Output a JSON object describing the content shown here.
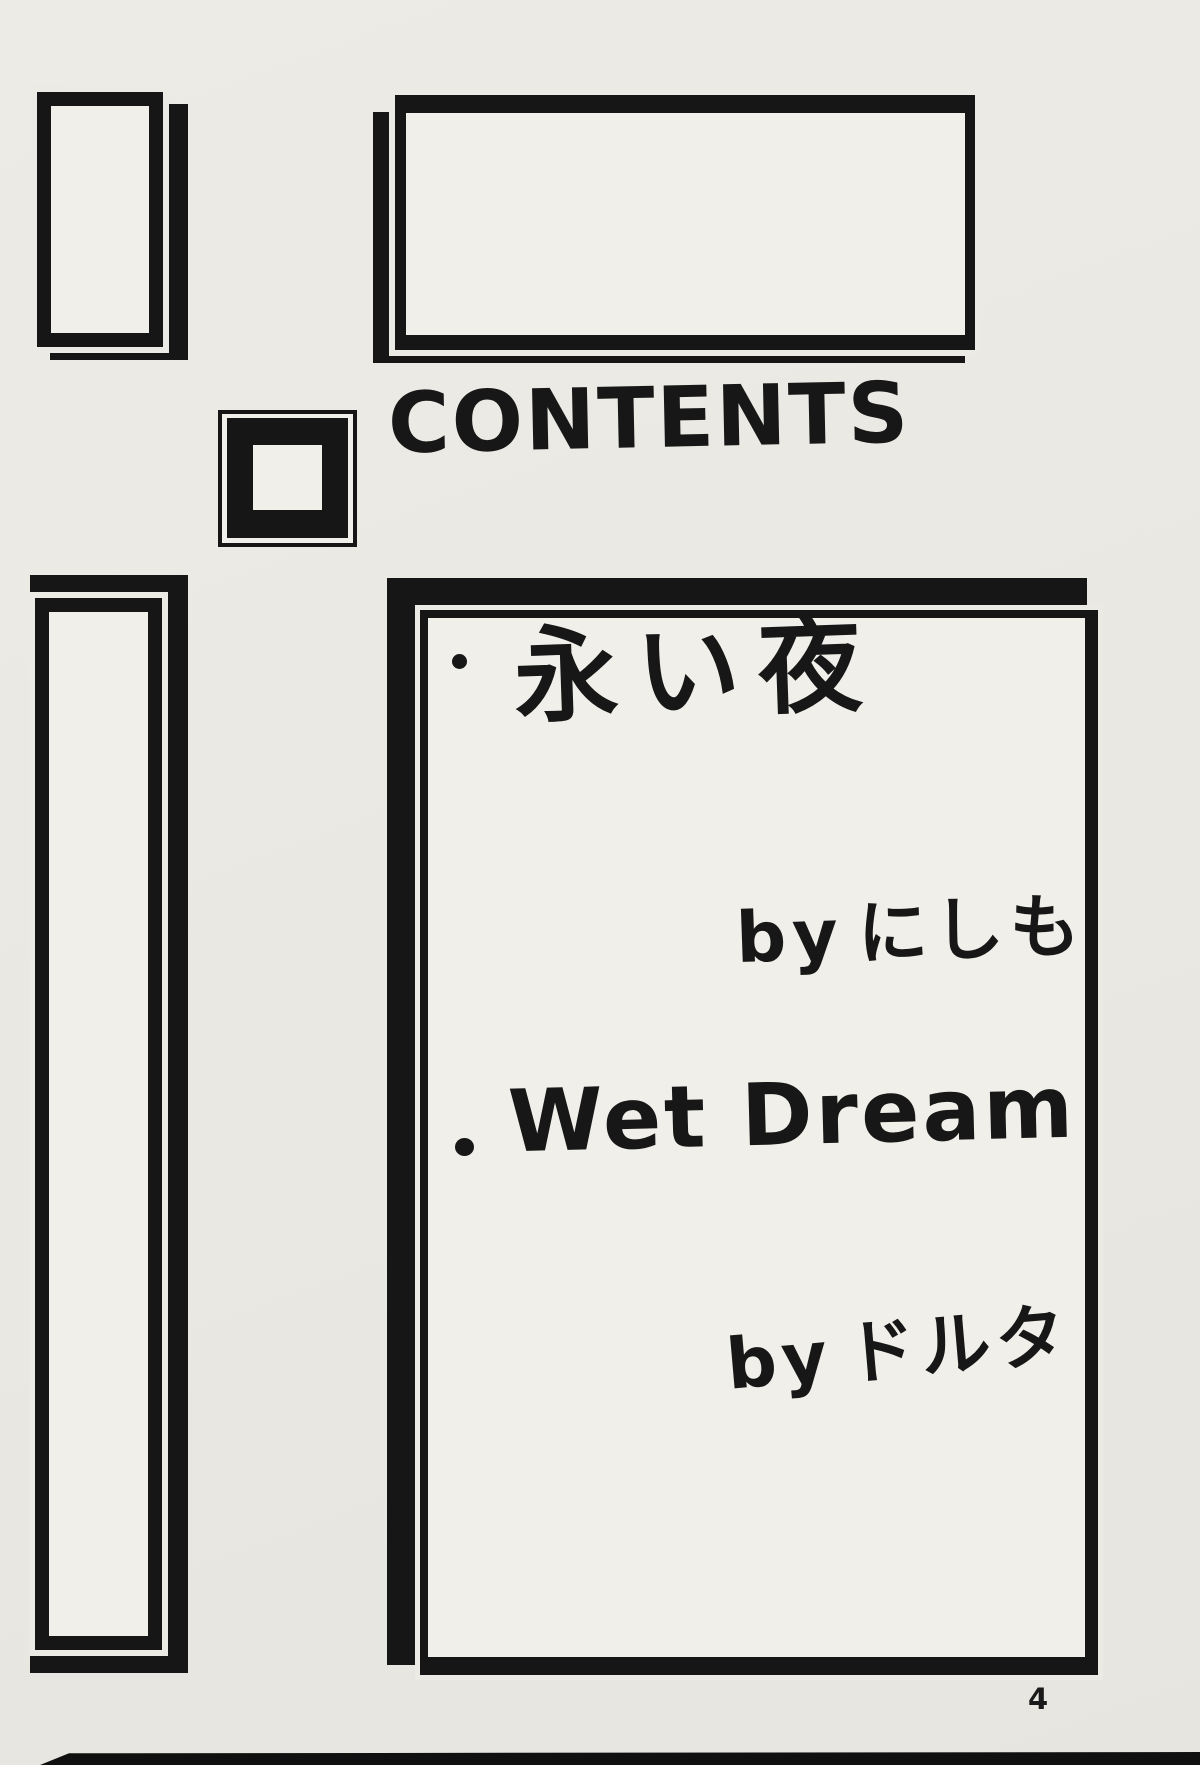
{
  "title": "CONTENTS",
  "contents": {
    "items": [
      {
        "title": "永い夜",
        "by": "by",
        "author": "にしも"
      },
      {
        "title": "Wet Dream",
        "by": "by",
        "author": "ドルタ"
      }
    ]
  },
  "page_number": "4",
  "colors": {
    "ink": "#1a1a1a",
    "paper": "#eceae5",
    "frame_fill": "#f1efe9"
  }
}
